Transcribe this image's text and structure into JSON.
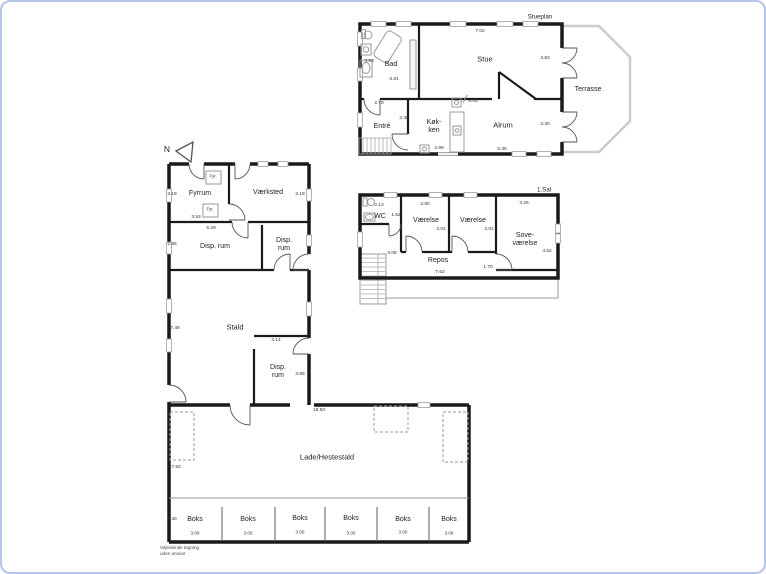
{
  "colors": {
    "frame_border": "#b7c4ea",
    "wall": "#1a1a1a",
    "terrace_outline": "#cccccc"
  },
  "compass": {
    "label": "N"
  },
  "note": {
    "line1": "Vejledende tegning",
    "line2": "uden ansvar"
  },
  "stueplan": {
    "title": "Stueplan",
    "rooms": {
      "bad": "Bad",
      "stue": "Stue",
      "entre": "Entré",
      "kokken": "Køk-\nken",
      "alrum": "Alrum",
      "terrasse": "Terrasse"
    },
    "dims": {
      "stue_top": "7.02",
      "bad_left": "3.83",
      "bad_bottom": "3.81",
      "stue_right": "3.83",
      "entre_top": "2.79",
      "kokken_top": "8.43",
      "entre_right": "3.38",
      "alrum_right": "3.30",
      "kokken_bottom": "2.99",
      "alrum_bottom": "5.35"
    }
  },
  "firstfloor": {
    "title": "1.Sal",
    "rooms": {
      "wc": "WC",
      "vaerelse1": "Værelse",
      "vaerelse2": "Værelse",
      "sovevaerelse": "Sove-\nværelse",
      "repos": "Repos"
    },
    "dims": {
      "wc_top": "2.13",
      "wc_right": "1.62",
      "vaerelse1_top": "2.90",
      "vaerelse1_depth": "3.02",
      "vaerelse2_depth": "3.02",
      "sovevaerelse_top": "3.25",
      "sovevaerelse_right": "4.52",
      "repos_left": "3.08",
      "repos_right": "1.70",
      "repos_bottom": "7.62"
    }
  },
  "outbuilding": {
    "fyr_label": "Fyr.",
    "rooms": {
      "fyrrum": "Fyrrum",
      "vaerksted": "Værksted",
      "disp_rum_large": "Disp. rum",
      "disp_rum_small": "Disp.\nrum",
      "stald": "Stald",
      "disp_rum_stald": "Disp.\nrum",
      "lade": "Lade/Hestestald"
    },
    "dims": {
      "fyrrum_left": "3.19",
      "vaerksted_right": "3.19",
      "fyrrum_bottom": "3.53",
      "disp_top": "5.29",
      "disp_left": "2.86",
      "stald_left": "7.46",
      "disp_stald_top": "3.14",
      "disp_stald_right": "3.88",
      "lade_top": "18.50",
      "lade_left": "7.92",
      "boks_left": "3.40"
    },
    "boks": [
      {
        "label": "Boks",
        "width": "3.00"
      },
      {
        "label": "Boks",
        "width": "3.00"
      },
      {
        "label": "Boks",
        "width": "3.00"
      },
      {
        "label": "Boks",
        "width": "3.00"
      },
      {
        "label": "Boks",
        "width": "3.00"
      },
      {
        "label": "Boks",
        "width": "3.06"
      }
    ]
  }
}
